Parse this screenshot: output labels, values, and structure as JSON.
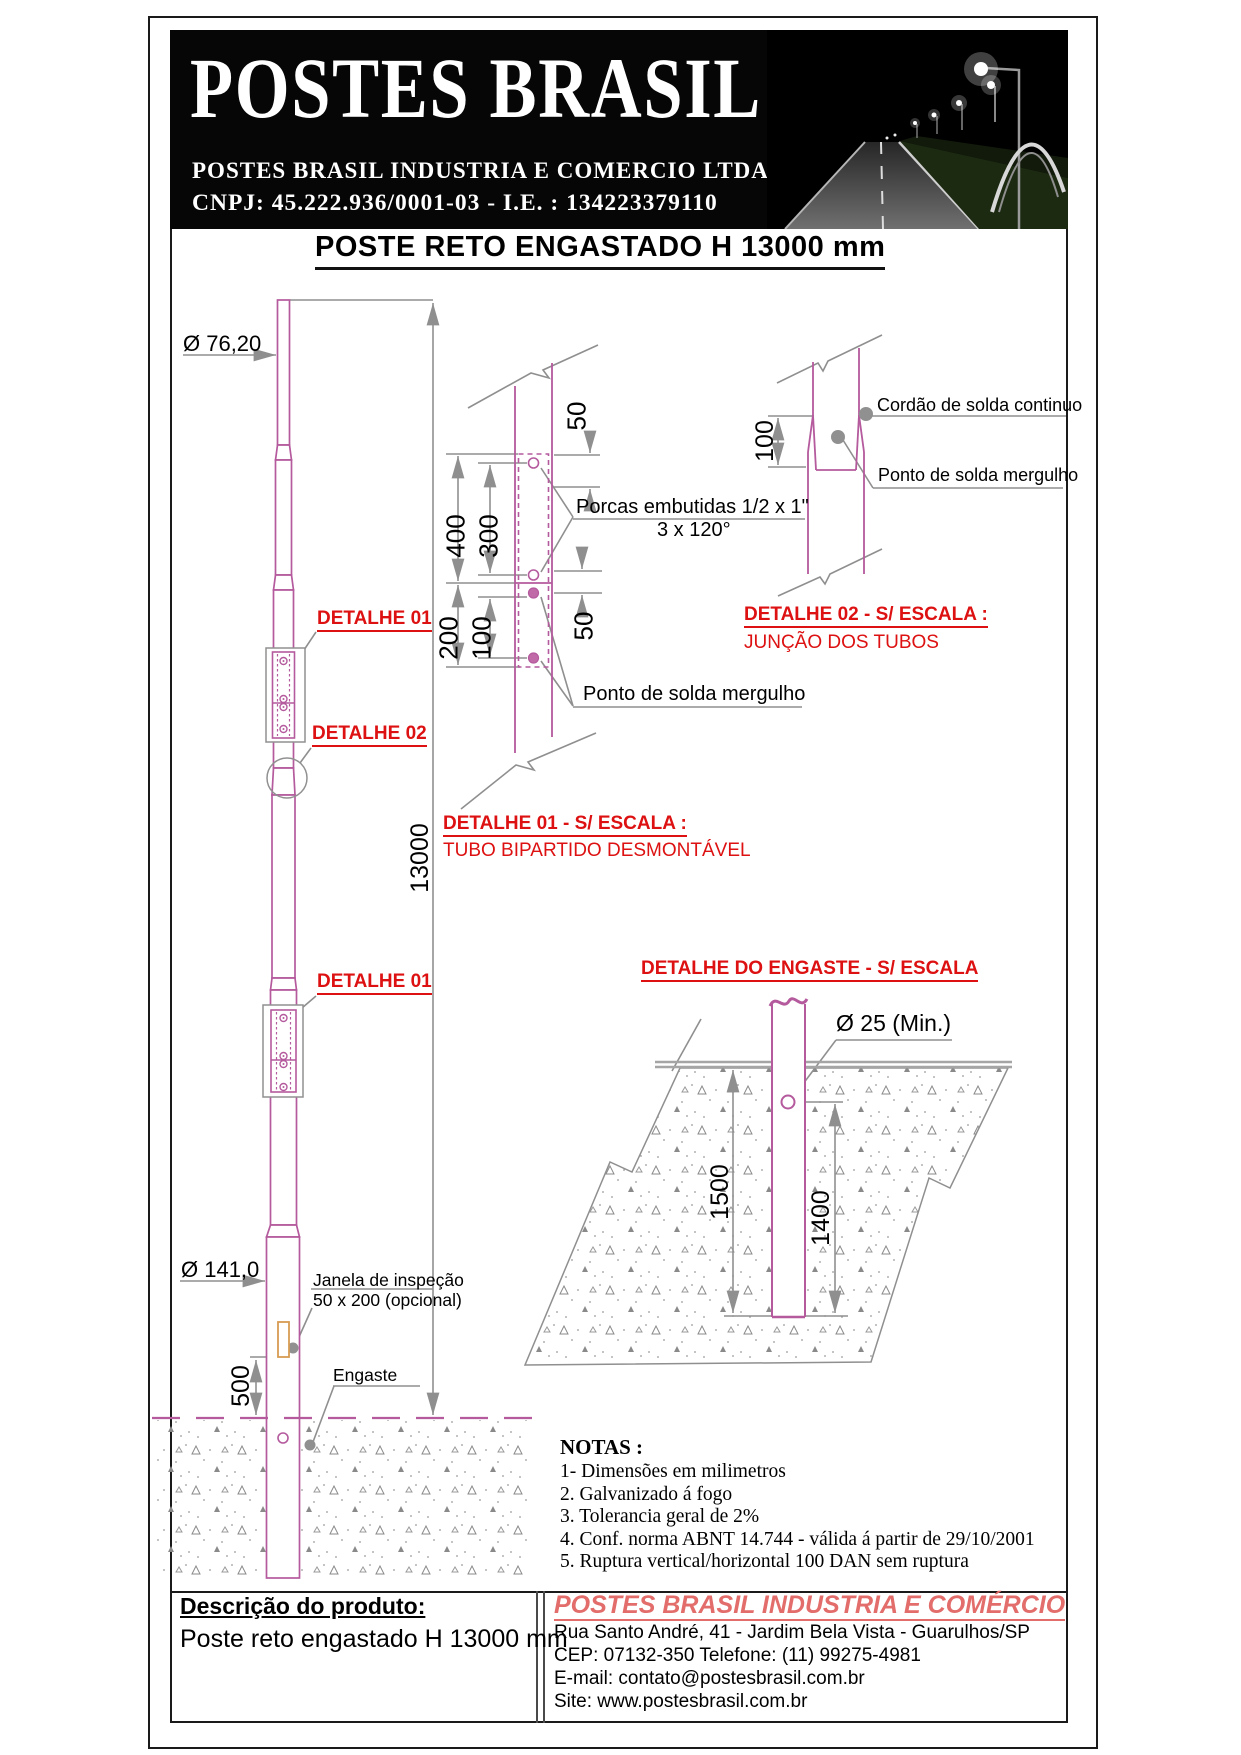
{
  "header": {
    "logo": "POSTES BRASIL",
    "company_line": "POSTES BRASIL INDUSTRIA E COMERCIO LTDA",
    "cnpj_line": "CNPJ: 45.222.936/0001-03 - I.E. : 134223379110"
  },
  "title": "POSTE RETO ENGASTADO H 13000 mm",
  "pole": {
    "dia_top": "Ø 76,20",
    "dia_bottom": "Ø 141,0",
    "height_dim": "13000",
    "embed_dim": "500",
    "detail1_label": "DETALHE 01",
    "detail2_label": "DETALHE 02",
    "detail1b_label": "DETALHE 01",
    "janela_line1": "Janela de inspeção",
    "janela_line2": "50 x 200 (opcional)",
    "engaste_label": "Engaste"
  },
  "detail1": {
    "dim_50_top": "50",
    "dim_400": "400",
    "dim_300": "300",
    "dim_200": "200",
    "dim_100": "100",
    "dim_50_bottom": "50",
    "porcas_line1": "Porcas embutidas 1/2 x 1\"",
    "porcas_line2": "3 x 120°",
    "ponto_solda": "Ponto de solda mergulho",
    "title": "DETALHE 01 - S/ ESCALA :",
    "subtitle": "TUBO BIPARTIDO DESMONTÁVEL"
  },
  "detail2": {
    "dim_100": "100",
    "cordao": "Cordão de solda continuo",
    "ponto": "Ponto de solda mergulho",
    "title": "DETALHE 02 - S/ ESCALA :",
    "subtitle": "JUNÇÃO DOS TUBOS"
  },
  "engaste": {
    "title": "DETALHE DO ENGASTE - S/ ESCALA",
    "dia": "Ø 25 (Min.)",
    "dim_1500": "1500",
    "dim_1400": "1400"
  },
  "notas": {
    "heading": "NOTAS :",
    "items": [
      "1- Dimensões em milimetros",
      "2. Galvanizado á fogo",
      "3. Tolerancia geral de 2%",
      "4. Conf. norma ABNT 14.744 - válida á partir de 29/10/2001",
      "5. Ruptura vertical/horizontal 100 DAN sem ruptura"
    ]
  },
  "footer": {
    "desc_heading": "Descrição do produto:",
    "desc_value": "Poste reto engastado H 13000 mm",
    "company": "POSTES BRASIL INDUSTRIA E COMÉRCIO",
    "address": "Rua Santo André, 41 - Jardim Bela Vista - Guarulhos/SP",
    "cep_phone": "CEP: 07132-350 Telefone: (11) 99275-4981",
    "email": "E-mail: contato@postesbrasil.com.br",
    "site": "Site: www.postesbrasil.com.br"
  },
  "colors": {
    "pole_pink": "#b45a9d",
    "label_red": "#dd1111",
    "footer_red": "#e26d6b",
    "dim_gray": "#8f8f8f",
    "janela_orange": "#d79b52"
  }
}
